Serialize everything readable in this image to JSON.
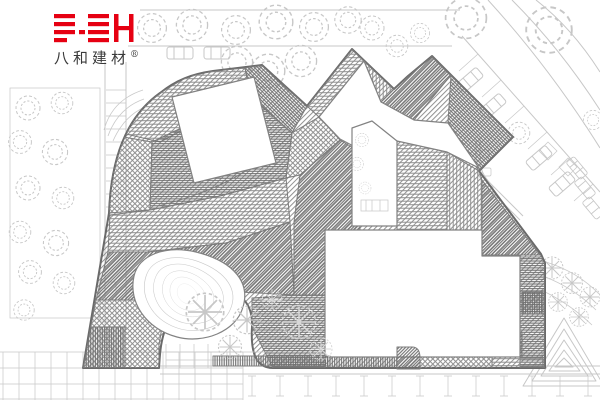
{
  "logo": {
    "mark_letters": "BH",
    "company_name": "八和建材",
    "registered_mark": "®",
    "brand_color": "#e60012"
  },
  "drawing": {
    "colors": {
      "background": "#ffffff",
      "outline": "#6a6a6a",
      "hatch_mid": "#8f8f8f",
      "hatch_dark": "#6e6e6e",
      "site": "#c7c7c7",
      "ink": "#3a3a3a"
    }
  }
}
